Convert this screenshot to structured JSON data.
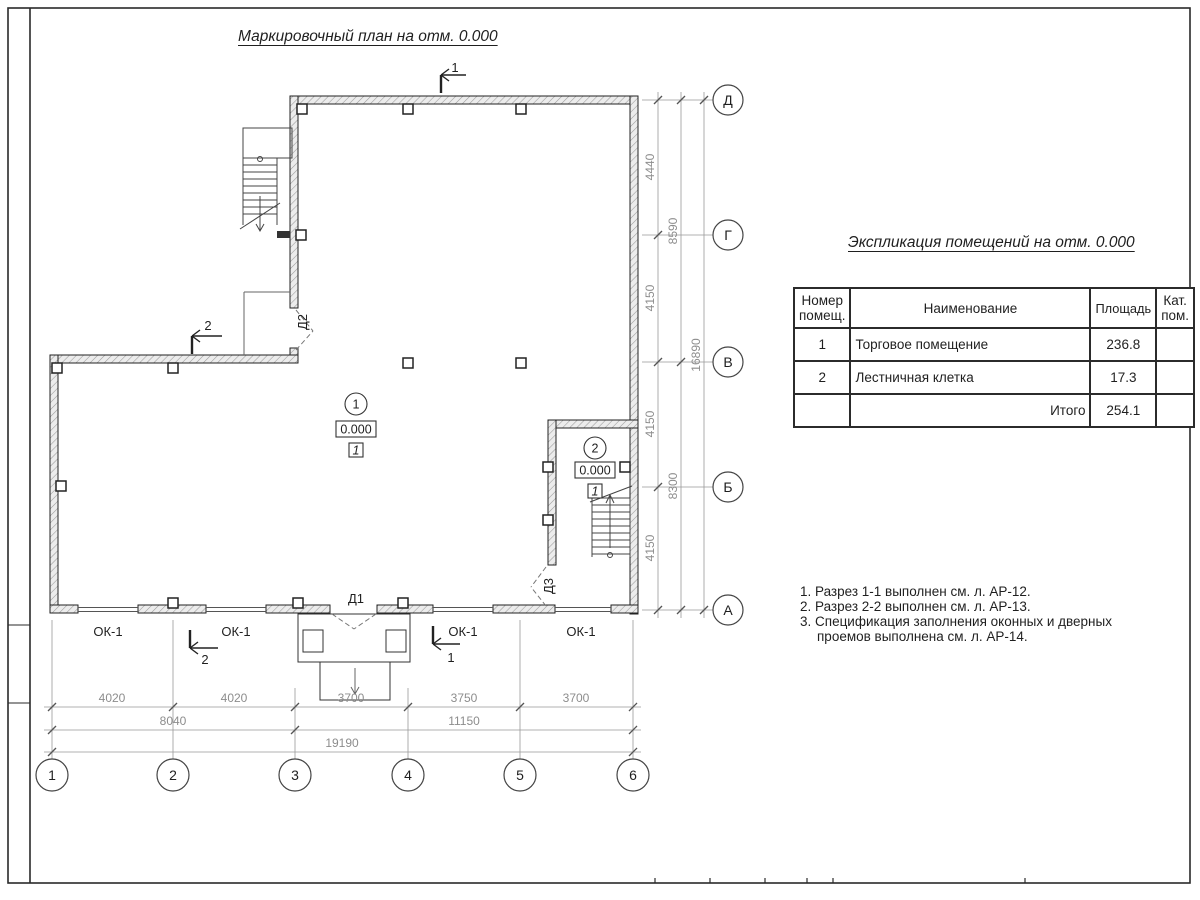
{
  "page": {
    "plan_title": "Маркировочный план на отм. 0.000",
    "table_title": "Экспликация помещений на отм. 0.000"
  },
  "colors": {
    "line": "#222222",
    "dim_text": "#8d8d8d",
    "wall_fill": "#ececec"
  },
  "plan": {
    "axes": {
      "rows": [
        "Д",
        "Г",
        "В",
        "Б",
        "А"
      ],
      "cols": [
        "1",
        "2",
        "3",
        "4",
        "5",
        "6"
      ]
    },
    "dims_right": {
      "inner": [
        "4440",
        "4150",
        "4150",
        "4150"
      ],
      "middle": [
        "8590",
        "8300"
      ],
      "overall": "16890"
    },
    "dims_bottom": {
      "inner": [
        "4020",
        "4020",
        "3700",
        "3750",
        "3700"
      ],
      "middle": [
        "8040",
        "11150"
      ],
      "overall": "19190"
    },
    "window_label": "ОК-1",
    "doors": {
      "d1": "Д1",
      "d2": "Д2",
      "d3": "Д3"
    },
    "sections": {
      "s1": "1",
      "s2": "2"
    },
    "rooms": [
      {
        "num": "1",
        "level": "0.000",
        "floor_type": "1"
      },
      {
        "num": "2",
        "level": "0.000",
        "floor_type": "1"
      }
    ]
  },
  "table": {
    "headers": {
      "num": "Номер помещ.",
      "name": "Наименование",
      "area": "Площадь",
      "cat": "Кат. пом."
    },
    "rows": [
      {
        "num": "1",
        "name": "Торговое помещение",
        "area": "236.8",
        "cat": ""
      },
      {
        "num": "2",
        "name": "Лестничная клетка",
        "area": "17.3",
        "cat": ""
      }
    ],
    "total": {
      "label": "Итого",
      "value": "254.1"
    }
  },
  "notes": {
    "lines": [
      "1. Разрез 1-1 выполнен см. л. АР-12.",
      "2. Разрез 2-2 выполнен см. л. АР-13.",
      "3. Спецификация заполнения оконных и дверных",
      "проемов выполнена см. л. АР-14."
    ]
  }
}
